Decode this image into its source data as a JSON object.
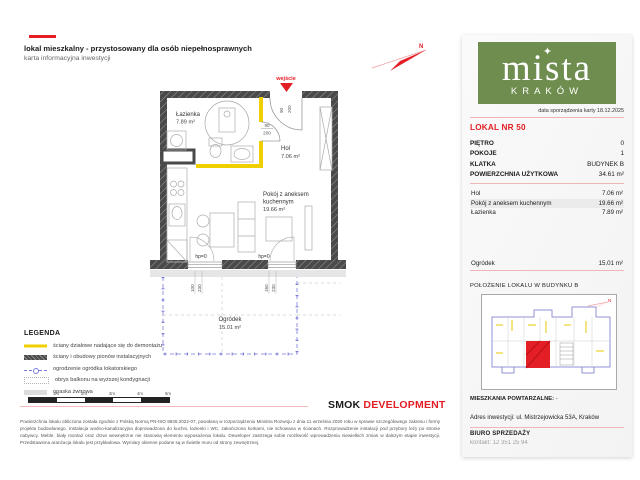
{
  "header": {
    "title": "lokal mieszkalny - przystosowany dla osób niepełnosprawnych",
    "subtitle": "karta informacyjna inwestycji"
  },
  "plan": {
    "entrance_label": "wejście",
    "north_label": "N",
    "entrance_dim": [
      "90",
      "200"
    ],
    "interior_door_dim": [
      "90",
      "200"
    ],
    "opening_left": {
      "label": "hp=0",
      "dim": [
        "100",
        "230"
      ]
    },
    "opening_right": {
      "label": "hp=0",
      "dim": [
        "160",
        "230"
      ]
    },
    "rooms": {
      "bathroom": {
        "name": "Łazienka",
        "area": "7.89 m²"
      },
      "hall": {
        "name": "Hol",
        "area": "7.06 m²"
      },
      "living": {
        "line1": "Pokój z aneksem",
        "line2": "kuchennym",
        "area": "19.66 m²"
      },
      "garden": {
        "name": "Ogródek",
        "area": "15.01 m²"
      }
    }
  },
  "legend": {
    "title": "LEGENDA",
    "items": [
      {
        "label": "ściany działowe nadające się do demontażu"
      },
      {
        "label": "ściany i obudowy pionów instalacyjnych"
      },
      {
        "label": "ogrodzenie ogródka lokatorskiego"
      },
      {
        "label": "obrys balkonu na wyższej kondygnacji"
      },
      {
        "label": "opaska żwirowa"
      }
    ]
  },
  "scalebar": {
    "labels": [
      "1m",
      "2m",
      "3m",
      "4m",
      "5m"
    ]
  },
  "footer": {
    "brand1": "SMOK ",
    "brand2": "DEVELOPMENT",
    "disclaimer": "Powierzchnia lokalu obliczona została zgodnie z Polską Normą PN-ISO 9836:2022-07, powołaną w rozporządzeniu Ministra Rozwoju z dnia 11 września 2020 roku w sprawie szczegółowego zakresu i formy projektu budowlanego. Instalacja wodno-kanalizacyjna doprowadzona do kuchni, łazienki i WC, zakończona korkami, nie schowana w ścianach. Rozprowadzenie instalacji pod przybory leży po stronie nabywcy. Meble, biały montaż oraz drzwi wewnętrzne nie stanowią elementu wyposażenia lokalu. Deweloper zastrzega sobie możliwość wprowadzenia niewielkich zmian w dalszym etapie inwestycji. Przedstawiona aranżacja lokalu jest przykładowa. Wymiary okienne podane są w świetle muru od strony zewnętrznej."
  },
  "panel": {
    "logo": {
      "word": "mista",
      "star": "✦",
      "city": "KRAKÓW"
    },
    "date_line": "data sporządzenia karty 18.12.2025",
    "lokal_label": "LOKAL NR 50",
    "attrs": [
      {
        "label": "PIĘTRO",
        "value": "0"
      },
      {
        "label": "POKOJE",
        "value": "1"
      },
      {
        "label": "KLATKA",
        "value": "BUDYNEK B"
      },
      {
        "label": "POWIERZCHNIA UŻYTKOWA",
        "value": "34.61 m²"
      }
    ],
    "room_rows": [
      {
        "label": "Hol",
        "value": "7.06 m²"
      },
      {
        "label": "Pokój z aneksem kuchennym",
        "value": "19.66 m²"
      },
      {
        "label": "Łazienka",
        "value": "7.89 m²"
      }
    ],
    "garden_row": {
      "label": "Ogródek",
      "value": "15.01 m²"
    },
    "location_label": "POŁOŻENIE LOKALU W BUDYNKU B",
    "map_north_label": "N",
    "repeatable_label": "MIESZKANIA POWTARZALNE:",
    "repeatable_value": " -",
    "address": "Adres inwestycji: ul. Mistrzejowicka 53A, Kraków",
    "office_label": "BIURO SPRZEDAŻY",
    "contact_line": "kontakt: 12 351 25 94"
  },
  "colors": {
    "accent_red": "#e31e24",
    "pink_line": "#f0b6b6",
    "logo_green": "#6e8d4e",
    "wall_dark": "#4a4a4a",
    "partition_yellow": "#f0cf00",
    "garden_blue": "#7b7bdc",
    "highlight_row": "#ebebeb"
  }
}
